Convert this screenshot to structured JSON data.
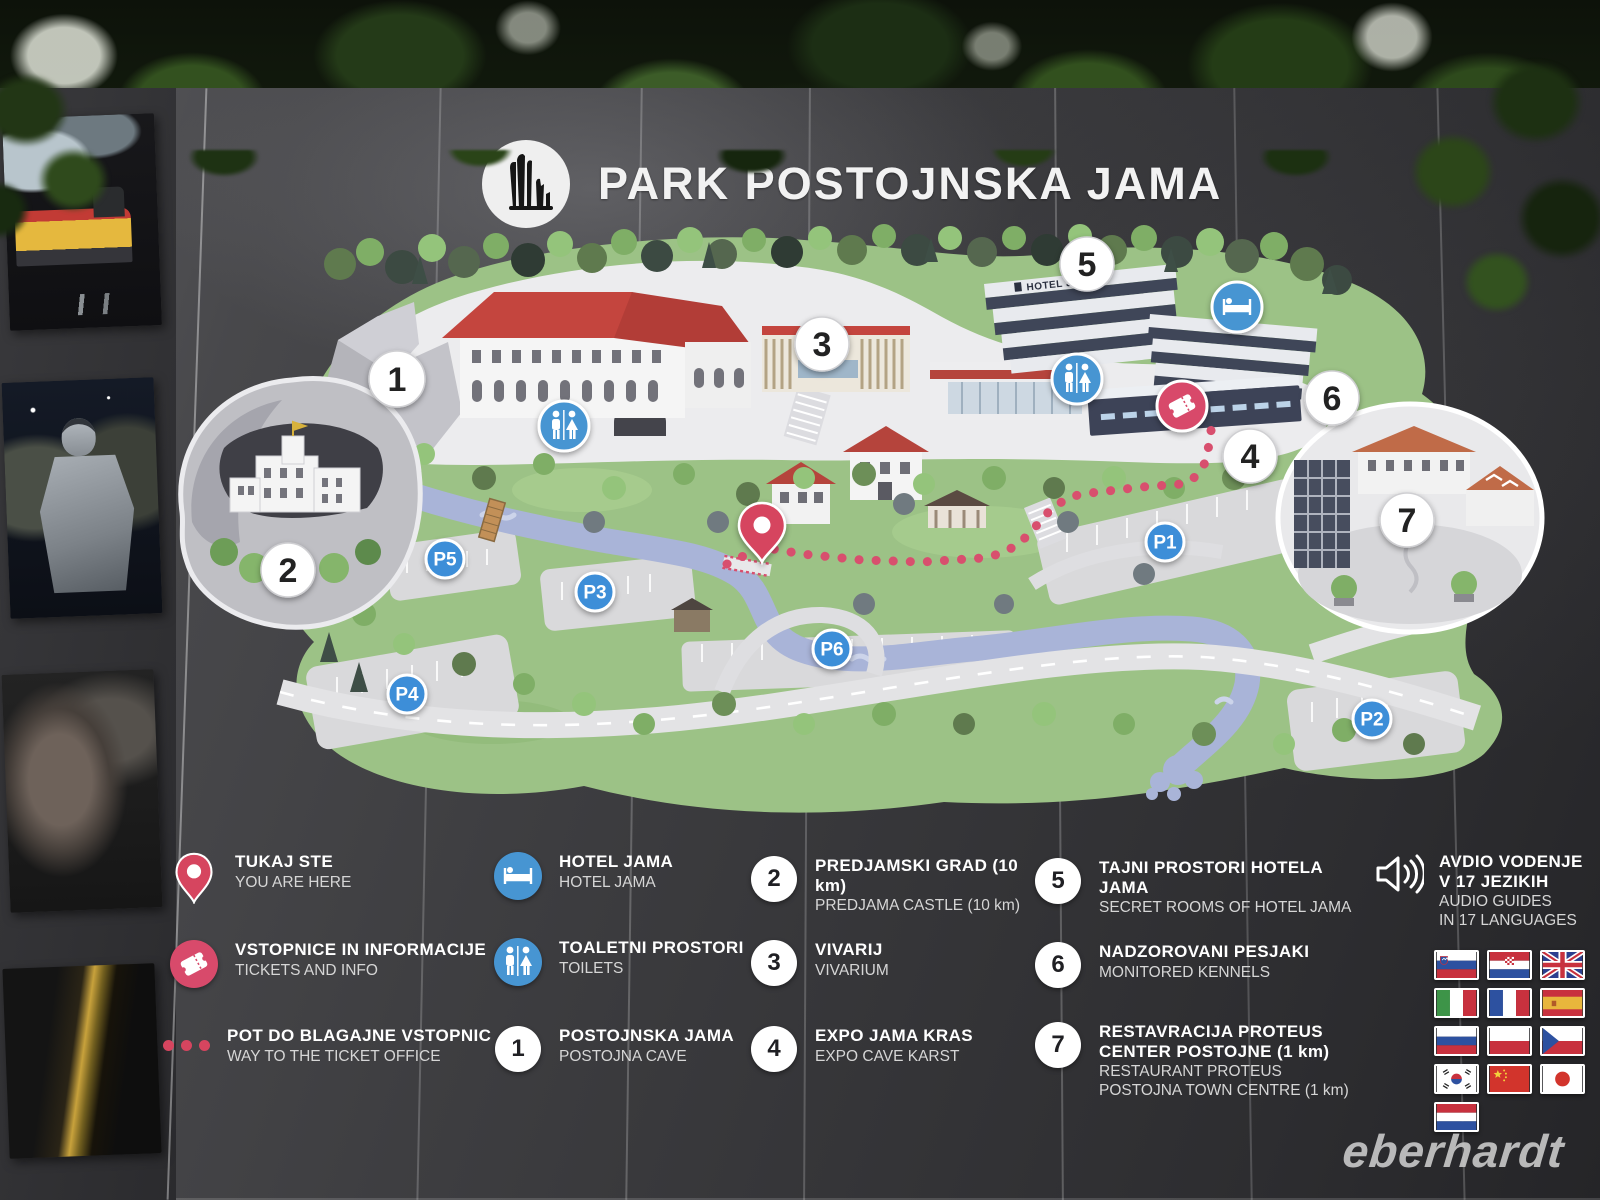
{
  "title": {
    "text": "PARK POSTOJNSKA JAMA",
    "logo": "stalagmites-cave-logo"
  },
  "map": {
    "numbered": [
      "1",
      "2",
      "3",
      "4",
      "5",
      "6",
      "7"
    ],
    "parking": [
      "P1",
      "P2",
      "P3",
      "P4",
      "P5",
      "P6"
    ],
    "hotel_sign": "HOTEL JAMA",
    "icons": [
      "you-are-here-pin",
      "toilets",
      "hotel-bed",
      "tickets",
      "way-dotted-path"
    ]
  },
  "legend": {
    "columns": [
      [
        {
          "icon": "you-are-here-pin",
          "sl": "TUKAJ STE",
          "en": "YOU ARE HERE"
        },
        {
          "icon": "tickets",
          "sl": "VSTOPNICE IN INFORMACIJE",
          "en": "TICKETS AND INFO"
        },
        {
          "icon": "dotted-path",
          "sl": "POT DO BLAGAJNE VSTOPNIC",
          "en": "WAY TO THE TICKET OFFICE"
        }
      ],
      [
        {
          "icon": "hotel-bed",
          "sl": "HOTEL JAMA",
          "en": "HOTEL JAMA"
        },
        {
          "icon": "toilets",
          "sl": "TOALETNI PROSTORI",
          "en": "TOILETS"
        },
        {
          "num": "1",
          "sl": "POSTOJNSKA JAMA",
          "en": "POSTOJNA CAVE"
        }
      ],
      [
        {
          "num": "2",
          "sl": "PREDJAMSKI GRAD (10 km)",
          "en": "PREDJAMA CASTLE  (10 km)"
        },
        {
          "num": "3",
          "sl": "VIVARIJ",
          "en": "VIVARIUM"
        },
        {
          "num": "4",
          "sl": "EXPO JAMA KRAS",
          "en": "EXPO CAVE KARST"
        }
      ],
      [
        {
          "num": "5",
          "sl": "TAJNI PROSTORI HOTELA JAMA",
          "en": "SECRET ROOMS OF HOTEL JAMA"
        },
        {
          "num": "6",
          "sl": "NADZOROVANI PESJAKI",
          "en": "MONITORED KENNELS"
        },
        {
          "num": "7",
          "sl": "RESTAVRACIJA PROTEUS\nCENTER POSTOJNE (1 km)",
          "en": "RESTAURANT PROTEUS\nPOSTOJNA TOWN CENTRE (1 km)"
        }
      ]
    ],
    "audio": {
      "icon": "speaker",
      "sl": "AVDIO VODENJE\nV 17 JEZIKIH",
      "en": "AUDIO GUIDES\nIN 17 LANGUAGES",
      "flags": [
        "slovenia",
        "croatia",
        "united-kingdom",
        "italy",
        "france",
        "spain",
        "russia",
        "poland",
        "czech-republic",
        "south-korea",
        "china",
        "japan",
        "netherlands"
      ]
    }
  },
  "photo_strip": [
    "cave-train",
    "knight-armour",
    "portrait-in-dark",
    "cave-lift"
  ],
  "watermark": "eberhardt",
  "colors": {
    "board_dark": "#3a3a3e",
    "terrain_green": "#9cc286",
    "river_blue": "#a9b4d8",
    "marker_blue": "#3c8ed8",
    "icon_blue": "#4795d2",
    "accent_pink": "#d84a6b",
    "roof_red": "#c4453e"
  }
}
